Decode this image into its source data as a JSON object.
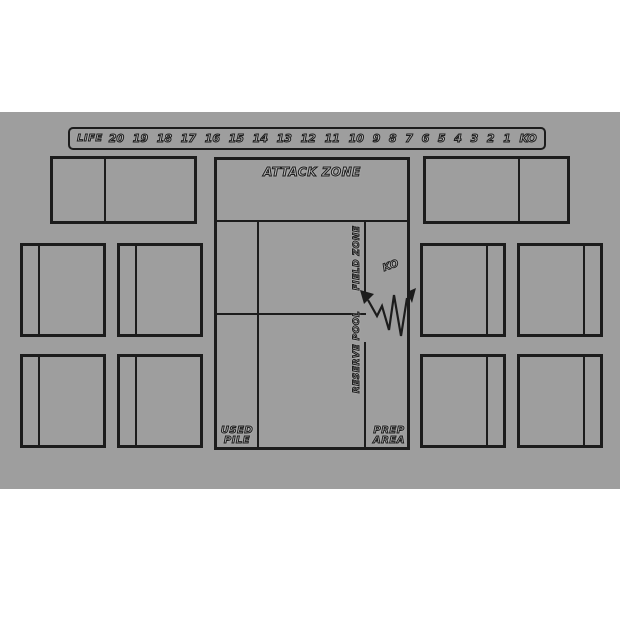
{
  "title": "card game playmat",
  "colors": {
    "page_background": "#ffffff",
    "mat": "#9e9e9e",
    "line": "#1c1c1c",
    "text_fill": "#b6b6b6",
    "text_halo": "#d2d2d2"
  },
  "life_track": {
    "label": "LIFE",
    "values": [
      "20",
      "19",
      "18",
      "17",
      "16",
      "15",
      "14",
      "13",
      "12",
      "11",
      "10",
      "9",
      "8",
      "7",
      "6",
      "5",
      "4",
      "3",
      "2",
      "1",
      "KO"
    ]
  },
  "zones": {
    "attack_zone_label": "ATTACK ZONE",
    "field_zone_label": "FIELD ZONE",
    "reserve_pool_label": "RESERVE POOL",
    "ko_label": "KO",
    "used_pile_line1": "USED",
    "used_pile_line2": "PILE",
    "prep_area_line1": "PREP",
    "prep_area_line2": "AREA"
  }
}
